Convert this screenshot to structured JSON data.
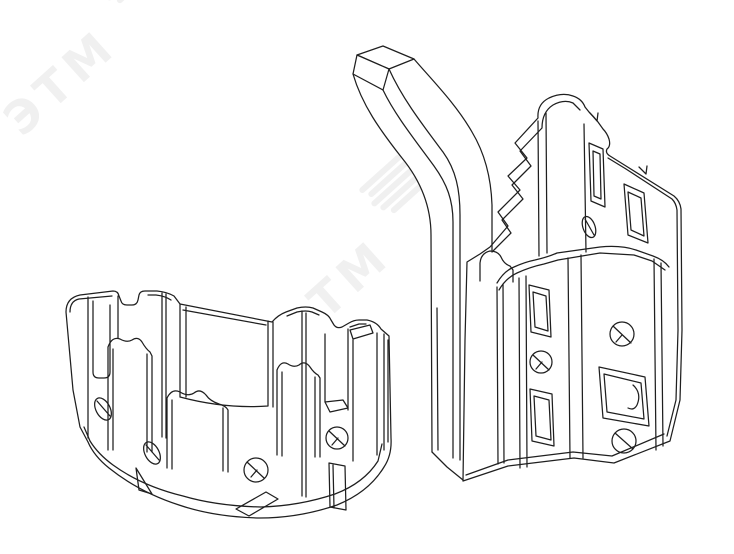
{
  "page": {
    "background_color": "#ffffff",
    "content_type": "technical-line-drawing"
  },
  "watermark": {
    "text": "ЭТМ",
    "color": "#f0f0f0"
  },
  "drawing": {
    "line_color": "#1f1f1f",
    "fill_color": "#ffffff",
    "parts": [
      {
        "name": "curved-channel-bracket-segment"
      },
      {
        "name": "channel-bracket-segment-with-hook-arm"
      }
    ]
  }
}
